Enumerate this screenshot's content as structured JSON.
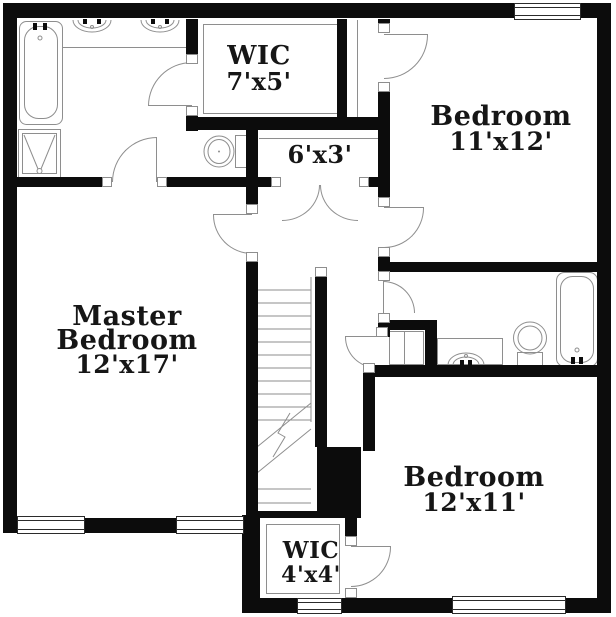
{
  "meta": {
    "type": "floor-plan"
  },
  "colors": {
    "wall": "#0c0c0c",
    "fixture_line": "#8e8e8e",
    "window_line": "#2b2b2b",
    "label": "#161616",
    "background": "#ffffff"
  },
  "rooms": {
    "wic_upper": {
      "name": "WIC",
      "dims": "7'x5'"
    },
    "bedroom_2": {
      "name": "Bedroom",
      "dims": "11'x12'"
    },
    "hall_closet": {
      "dims": "6'x3'"
    },
    "master_bedroom": {
      "name_line1": "Master",
      "name_line2": "Bedroom",
      "dims": "12'x17'"
    },
    "bedroom_3": {
      "name": "Bedroom",
      "dims": "12'x11'"
    },
    "wic_lower": {
      "name": "WIC",
      "dims": "4'x4'"
    }
  },
  "fixtures": [
    "master-bathtub",
    "vanity-sink-left",
    "vanity-sink-right",
    "shower-stall",
    "master-toilet",
    "staircase",
    "hall-bath-sink",
    "hall-bath-toilet",
    "hall-bathtub"
  ],
  "features": {
    "windows": 5,
    "door_arcs": 10,
    "double_doors": 1
  }
}
